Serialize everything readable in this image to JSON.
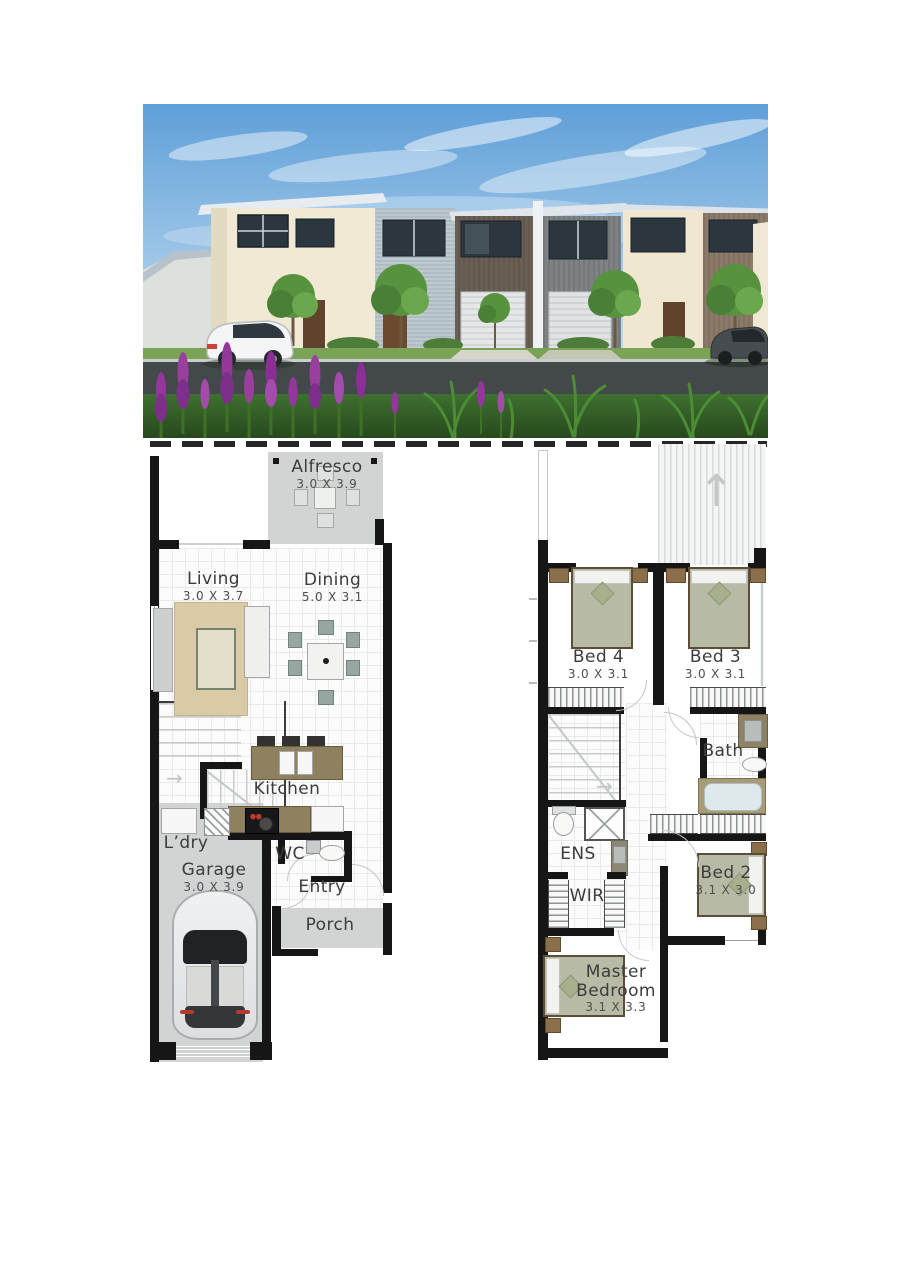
{
  "floorplans": {
    "ground": {
      "alfresco": {
        "name": "Alfresco",
        "dims": "3.0 X 3.9"
      },
      "living": {
        "name": "Living",
        "dims": "3.0 X 3.7"
      },
      "dining": {
        "name": "Dining",
        "dims": "5.0 X 3.1"
      },
      "kitchen": {
        "name": "Kitchen"
      },
      "laundry": {
        "name": "L’dry"
      },
      "wc": {
        "name": "WC"
      },
      "entry": {
        "name": "Entry"
      },
      "garage": {
        "name": "Garage",
        "dims": "3.0 X 3.9"
      },
      "porch": {
        "name": "Porch"
      }
    },
    "upper": {
      "bed4": {
        "name": "Bed 4",
        "dims": "3.0 X 3.1"
      },
      "bed3": {
        "name": "Bed 3",
        "dims": "3.0 X 3.1"
      },
      "bath": {
        "name": "Bath"
      },
      "ens": {
        "name": "ENS"
      },
      "wir": {
        "name": "WIR"
      },
      "bed2": {
        "name": "Bed 2",
        "dims": "3.1 X 3.0"
      },
      "master": {
        "name": "Master Bedroom",
        "dims": "3.1 X 3.3"
      }
    }
  },
  "icons": {
    "up_arrow": "↑",
    "right_arrow": "→"
  },
  "colors": {
    "wall": "#161616",
    "zone_grey": "#d2d4d3",
    "bench_brown": "#8f815f",
    "bed_khaki": "#b7bba6",
    "timber_brown": "#8a6f4a",
    "rug_tan": "#dbcaa6",
    "chair_teal": "#97a69f",
    "tub_blue": "#dde9ea",
    "sky_blue": "#5f9fd8",
    "grass_green": "#356427",
    "flower_purple": "#93379b"
  }
}
